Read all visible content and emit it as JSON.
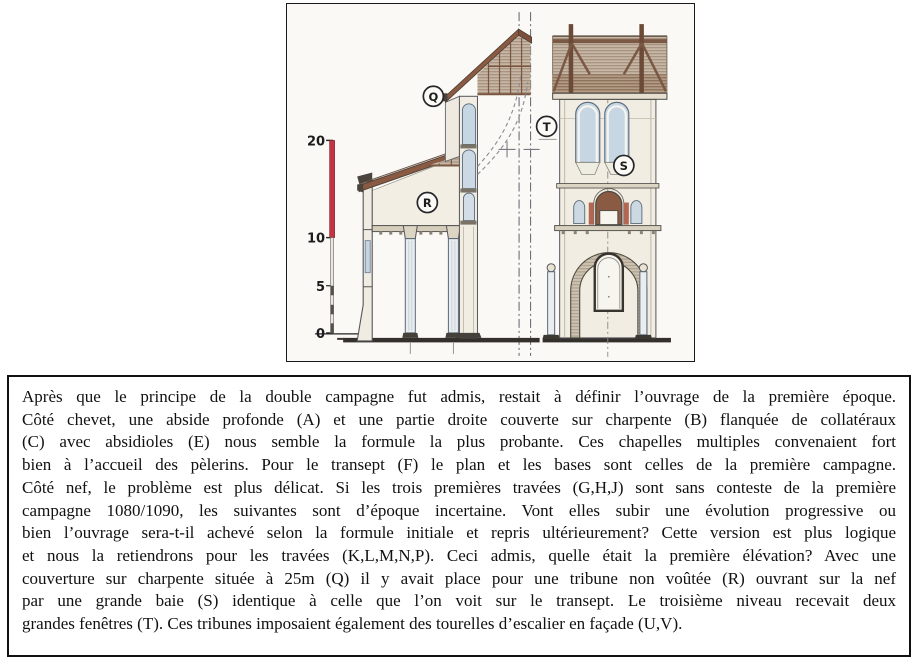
{
  "figure": {
    "caption": "Coupe et élévation — première élévation de la nef et du transept",
    "scale": {
      "unit": "m",
      "labels": [
        "20",
        "10",
        "5",
        "0"
      ]
    },
    "labels": {
      "q": "Q",
      "r": "R",
      "s": "S",
      "t": "T"
    },
    "colors": {
      "scale_red": "#c23440",
      "roof_brown": "#8a5a42",
      "roof_brown_dark": "#7c4f3a",
      "timber": "#7a5844",
      "glass_blue": "#c7d6e3",
      "wall_cream": "#f1ede2",
      "paper": "#faf9f5",
      "ink": "#55555c",
      "ground": "#34302c",
      "accent_redbrown": "#b26752"
    }
  },
  "textbox": {
    "lines": [
      "Après que le principe de la double campagne fut admis, restait à définir l’ouvrage de la première époque.",
      "Côté chevet, une abside profonde (A) et une partie droite couverte sur charpente (B) flanquée de collatéraux",
      "(C) avec absidioles (E) nous semble la formule la plus probante. Ces chapelles multiples convenaient fort",
      "bien à l’accueil des pèlerins. Pour le transept (F)  le plan et les bases sont celles de la première campagne.",
      "Côté nef, le problème est plus délicat. Si les trois premières travées (G,H,J) sont sans conteste de la première",
      "campagne 1080/1090, les suivantes sont d’époque incertaine. Vont elles subir une évolution progressive ou",
      "bien l’ouvrage sera-t-il achevé selon la formule initiale et repris ultérieurement? Cette version est plus logique",
      "et nous la retiendrons pour les travées (K,L,M,N,P). Ceci admis, quelle était la première élévation? Avec une",
      "couverture sur charpente située à 25m (Q) il y avait place pour une tribune non voûtée (R) ouvrant sur la nef",
      "par une grande baie (S) identique à celle que l’on voit sur le transept. Le troisième niveau recevait deux",
      "grandes fenêtres (T). Ces tribunes imposaient également des tourelles d’escalier en façade (U,V)."
    ]
  }
}
